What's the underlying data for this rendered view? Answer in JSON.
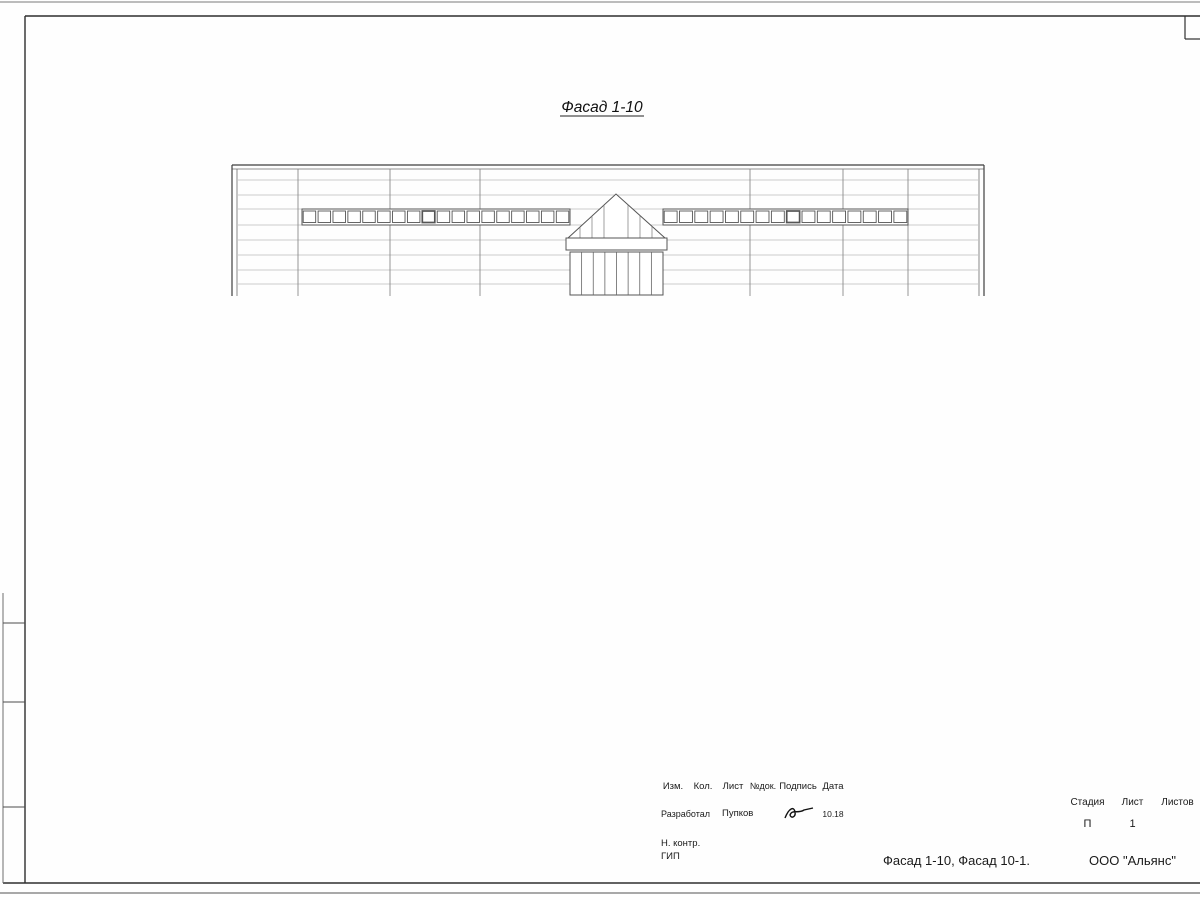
{
  "sheet_title": "Фасад 1-10, Фасад 10-1.",
  "facades": [
    {
      "id": "facade-1-10",
      "title": "Фасад 1-10",
      "title_x": 602,
      "title_y": 112,
      "building": {
        "left": 232,
        "right": 984,
        "top": 165,
        "parapet": 169,
        "ground": 296
      },
      "ground_line": {
        "x1": 205,
        "x2": 1006
      },
      "panel_lines": [
        180,
        195,
        209,
        225,
        240,
        255,
        270,
        284
      ],
      "columns": [
        298,
        390,
        480,
        750,
        843,
        908
      ],
      "bands": [
        {
          "x1": 302,
          "x2": 570,
          "y1": 209,
          "y2": 225,
          "count": 18,
          "marked": 8
        },
        {
          "x1": 663,
          "x2": 908,
          "y1": 209,
          "y2": 225,
          "count": 16,
          "marked": 8
        }
      ],
      "entrance": {
        "apex_x": 616,
        "apex_y": 194,
        "base_x1": 568,
        "base_x2": 665,
        "base_y": 238,
        "canopy": {
          "x1": 566,
          "x2": 667,
          "y1": 238,
          "y2": 250
        },
        "door": {
          "x1": 570,
          "x2": 663,
          "y1": 252,
          "y2": 295,
          "panels": 8,
          "handle_xs": [
            592,
            637
          ],
          "handle_y": 274
        },
        "mullions": [
          580,
          592,
          604,
          628,
          640,
          652
        ]
      },
      "dimension": {
        "text": "49700",
        "y": 314,
        "x1": 237,
        "x2": 983,
        "tx": 605,
        "ty": 309
      },
      "axes": [
        {
          "label": "1",
          "cx": 237,
          "cy": 333
        },
        {
          "label": "10",
          "cx": 983,
          "cy": 333
        }
      ],
      "marks": [
        {
          "text": "+8.870",
          "tx": 198,
          "ty": 149,
          "ul": [
            178,
            218,
            152
          ],
          "arrow": {
            "dir": "down",
            "x": 213,
            "y": 164,
            "stem": 152
          }
        },
        {
          "text": "+5.870",
          "tx": 444,
          "ty": 193,
          "ul": [
            425,
            463,
            196
          ],
          "arrow": {
            "dir": "down",
            "x": 428,
            "y": 208,
            "stem": 196
          }
        },
        {
          "text": "+4.870",
          "tx": 447,
          "ty": 248,
          "ul": [
            428,
            466,
            251
          ],
          "arrow": {
            "dir": "up",
            "x": 428,
            "y": 226,
            "stem": 251
          }
        },
        {
          "text": "+6.870",
          "tx": 641,
          "ty": 181,
          "ul": [
            622,
            661,
            184
          ],
          "arrow": {
            "dir": "down",
            "x": 624,
            "y": 196,
            "stem": 184
          }
        },
        {
          "text": "+3.870",
          "tx": 536,
          "ty": 250,
          "ul": [
            517,
            555,
            253
          ],
          "arrow": {
            "dir": "up-right",
            "x": 558,
            "y": 231
          }
        },
        {
          "text": "+2.870",
          "tx": 536,
          "ty": 269,
          "ul": [
            517,
            555,
            272
          ],
          "arrow": {
            "dir": "up-right",
            "x": 558,
            "y": 251
          }
        },
        {
          "text": "+3.070",
          "tx": 694,
          "ty": 265,
          "ul": [
            675,
            713,
            268
          ],
          "arrow": {
            "dir": "up-left",
            "x": 672,
            "y": 246
          }
        },
        {
          "text": "+5.870",
          "tx": 805,
          "ty": 193,
          "ul": [
            786,
            824,
            196
          ],
          "arrow": {
            "dir": "down",
            "x": 789,
            "y": 208,
            "stem": 196
          }
        },
        {
          "text": "+4.870",
          "tx": 806,
          "ty": 248,
          "ul": [
            787,
            825,
            251
          ],
          "arrow": {
            "dir": "up",
            "x": 789,
            "y": 226,
            "stem": 251
          }
        }
      ]
    },
    {
      "id": "facade-10-1",
      "title": "Фасад 10-1",
      "title_x": 602,
      "title_y": 409,
      "building": {
        "left": 233,
        "right": 985,
        "top": 460,
        "parapet": 472,
        "ground": 593
      },
      "ground_line": {
        "x1": 217,
        "x2": 1016
      },
      "panel_lines": [
        487,
        502,
        517,
        532,
        547,
        562,
        577
      ],
      "columns": [
        310,
        377,
        467,
        557,
        645,
        737,
        827,
        918
      ],
      "bands": [
        {
          "x1": 377,
          "x2": 467,
          "y1": 504,
          "y2": 521,
          "count": 6,
          "marked": 3
        },
        {
          "x1": 557,
          "x2": 737,
          "y1": 504,
          "y2": 521,
          "count": 12,
          "marked": 7
        },
        {
          "x1": 827,
          "x2": 918,
          "y1": 504,
          "y2": 521,
          "count": 6,
          "marked": 3
        }
      ],
      "hatch": {
        "x1": 237,
        "x2": 310,
        "y1": 533,
        "y2": 593
      },
      "louver": {
        "x1": 248,
        "x2": 291,
        "y1": 537,
        "y2": 574
      },
      "doors": [
        {
          "x1": 408,
          "x2": 435,
          "y1": 557,
          "y2": 593
        },
        {
          "x1": 858,
          "x2": 887,
          "y1": 557,
          "y2": 593
        }
      ],
      "dimension": {
        "text": "49700",
        "y": 614,
        "x1": 237,
        "x2": 983,
        "tx": 612,
        "ty": 609
      },
      "axes": [
        {
          "label": "10",
          "cx": 233,
          "cy": 631
        },
        {
          "label": "1",
          "cx": 983,
          "cy": 631
        }
      ],
      "marks": [
        {
          "text": "+8.106",
          "tx": 322,
          "ty": 453,
          "ul": [
            302,
            342,
            456
          ],
          "arrow": {
            "dir": "down",
            "x": 337,
            "y": 470,
            "stem": 456
          }
        },
        {
          "text": "+8.870",
          "tx": 1024,
          "ty": 448,
          "ul": [
            1005,
            1043,
            451
          ],
          "arrow": {
            "dir": "down",
            "x": 1008,
            "y": 461,
            "stem": 451
          }
        },
        {
          "text": "+3.870",
          "tx": 197,
          "ty": 524,
          "ul": [
            178,
            216,
            527
          ],
          "arrow": {
            "dir": "down",
            "x": 190,
            "y": 537,
            "stem": 527
          }
        },
        {
          "text": "+1.350",
          "tx": 197,
          "ty": 563,
          "ul": [
            178,
            216,
            566
          ],
          "arrow": {
            "dir": "down",
            "x": 190,
            "y": 575,
            "stem": 566
          }
        },
        {
          "text": "+5.870",
          "tx": 447,
          "ty": 488,
          "ul": [
            428,
            466,
            491
          ],
          "arrow": {
            "dir": "down",
            "x": 431,
            "y": 504,
            "stem": 491
          }
        },
        {
          "text": "+4.870",
          "tx": 449,
          "ty": 548,
          "ul": [
            430,
            468,
            551
          ],
          "arrow": {
            "dir": "up",
            "x": 431,
            "y": 523,
            "stem": 551
          }
        },
        {
          "text": "+2.200",
          "tx": 401,
          "ty": 548,
          "ul": [
            382,
            420,
            551
          ],
          "arrow": {
            "dir": "down",
            "x": 415,
            "y": 556,
            "stem": 551
          }
        },
        {
          "text": "+5.870",
          "tx": 690,
          "ty": 488,
          "ul": [
            671,
            709,
            491
          ],
          "arrow": {
            "dir": "down",
            "x": 669,
            "y": 504,
            "stem": 491
          }
        },
        {
          "text": "+4.870",
          "tx": 690,
          "ty": 548,
          "ul": [
            671,
            709,
            551
          ],
          "arrow": {
            "dir": "up",
            "x": 669,
            "y": 523,
            "stem": 551
          }
        },
        {
          "text": "+5.870",
          "tx": 905,
          "ty": 488,
          "ul": [
            886,
            924,
            491
          ],
          "arrow": {
            "dir": "down",
            "x": 879,
            "y": 504,
            "stem": 491
          }
        },
        {
          "text": "+4.870",
          "tx": 902,
          "ty": 548,
          "ul": [
            883,
            921,
            551
          ],
          "arrow": {
            "dir": "up",
            "x": 879,
            "y": 523,
            "stem": 551
          }
        },
        {
          "text": "+2.200",
          "tx": 856,
          "ty": 548,
          "ul": [
            837,
            875,
            551
          ],
          "arrow": {
            "dir": "down",
            "x": 869,
            "y": 556,
            "stem": 551
          }
        }
      ]
    }
  ],
  "titleblock": {
    "header": {
      "izm": "Изм.",
      "kol": "Кол.",
      "list": "Лист",
      "ndok": "№док.",
      "podpis": "Подпись",
      "data": "Дата"
    },
    "rows": {
      "developed_label": "Разработал",
      "developed_name": "Пупков",
      "developed_date": "10.18",
      "ncontr_label": "Н. контр.",
      "gip_label": "ГИП"
    },
    "right": {
      "stage_label": "Стадия",
      "sheet_label": "Лист",
      "sheets_label": "Листов",
      "stage_value": "П",
      "sheet_value": "1",
      "sheets_value": ""
    },
    "doc_title": "Фасад 1-10, Фасад 10-1.",
    "company": "ООО \"Альянс\""
  },
  "colors": {
    "line_main": "#3f3f3f",
    "line_thin": "#9a9a9a",
    "line_column": "#7d7d7d",
    "ground": "#585858",
    "dim_gray": "#b3b3b3",
    "dim_text": "#a8a8a8",
    "text": "#1c1c1c",
    "frame": "#2e2e2e"
  }
}
